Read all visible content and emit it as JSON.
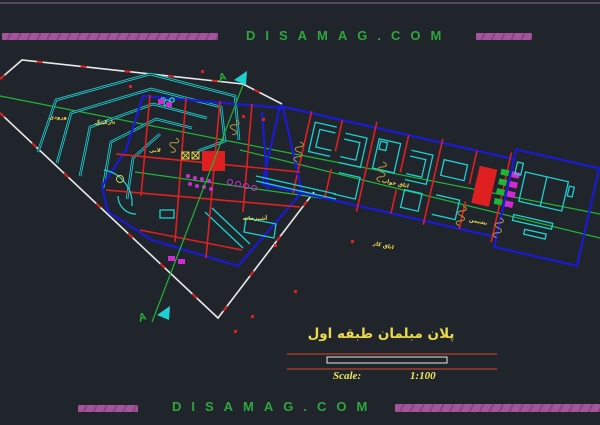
{
  "colors": {
    "bg": "#20252c",
    "line-top": "#5d4364",
    "bar": "#a3559b",
    "bar-stripe": "#8a4384",
    "site-green": "#2fa63d",
    "white": "#e9e9e9",
    "red": "#e02020",
    "blue": "#1a1ad6",
    "cyan": "#1fd0d0",
    "green": "#21b535",
    "yellow": "#ecd94a",
    "magenta": "#d22ad2",
    "olive": "#a6913f",
    "maroon": "#9e3c28",
    "scale-yellow": "#efe75e"
  },
  "header": {
    "site_text": "DISAMAG.COM"
  },
  "footer": {
    "site_text": "DISAMAG.COM"
  },
  "title_block": {
    "title": "پلان مبلمان طبقه  اول",
    "scale_label": "Scale:",
    "scale_value": "1:100"
  },
  "section": {
    "top": "A",
    "bottom": "A"
  },
  "plan": {
    "labels": [
      {
        "text": "پارکینگ"
      },
      {
        "text": "ورودی"
      },
      {
        "text": "لابی"
      },
      {
        "text": "آشپزخانه"
      },
      {
        "text": "اتاق خواب"
      },
      {
        "text": "نشیمن"
      },
      {
        "text": "اتاق کار"
      }
    ]
  }
}
